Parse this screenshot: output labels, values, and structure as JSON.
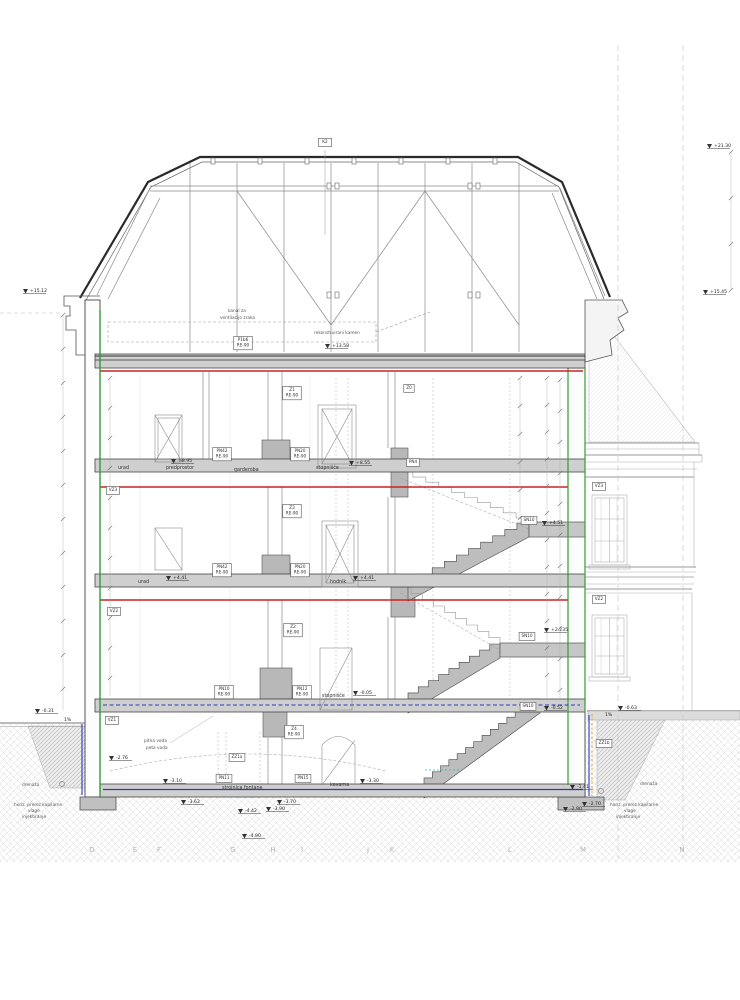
{
  "colors": {
    "slab_red": "#cc2222",
    "wall_green": "#2e9e38",
    "moisture_blue": "#2b3bbb",
    "membrane_orange": "#e0a030",
    "teal_line": "#2ab6c9"
  },
  "tags": [
    {
      "t": "K2",
      "x": 325,
      "y": 143,
      "big": true
    },
    {
      "t": "P1b6|RE-90",
      "x": 243,
      "y": 341
    },
    {
      "t": "Z1|RE-90",
      "x": 292,
      "y": 391
    },
    {
      "t": "Z0",
      "x": 409,
      "y": 389
    },
    {
      "t": "PN42|RE-90",
      "x": 222,
      "y": 452
    },
    {
      "t": "PN20|RE-90",
      "x": 300,
      "y": 452
    },
    {
      "t": "PN4",
      "x": 413,
      "y": 463
    },
    {
      "t": "VZ3",
      "x": 113,
      "y": 491
    },
    {
      "t": "VZ3",
      "x": 599,
      "y": 487
    },
    {
      "t": "Z3|RE-90",
      "x": 292,
      "y": 509
    },
    {
      "t": "SN10",
      "x": 529,
      "y": 521
    },
    {
      "t": "PN42|RE-90",
      "x": 222,
      "y": 568
    },
    {
      "t": "PN20|RE-90",
      "x": 300,
      "y": 568
    },
    {
      "t": "VZ2",
      "x": 114,
      "y": 612
    },
    {
      "t": "VZ2",
      "x": 599,
      "y": 600
    },
    {
      "t": "Z2|RE-90",
      "x": 293,
      "y": 628
    },
    {
      "t": "SN10",
      "x": 527,
      "y": 637
    },
    {
      "t": "PN10|RE-90",
      "x": 224,
      "y": 690
    },
    {
      "t": "PN12|RE-90",
      "x": 302,
      "y": 690
    },
    {
      "t": "SN10",
      "x": 528,
      "y": 707
    },
    {
      "t": "VZ1",
      "x": 112,
      "y": 721
    },
    {
      "t": "Z4|RE-90",
      "x": 294,
      "y": 730
    },
    {
      "t": "ZZ1a",
      "x": 237,
      "y": 758
    },
    {
      "t": "ZZ1b",
      "x": 604,
      "y": 744
    },
    {
      "t": "PN11",
      "x": 224,
      "y": 779
    },
    {
      "t": "PN15",
      "x": 303,
      "y": 779
    }
  ],
  "levels": [
    {
      "t": "+21.30",
      "x": 716,
      "y": 143
    },
    {
      "t": "+15.45",
      "x": 712,
      "y": 289
    },
    {
      "t": "+15.12",
      "x": 32,
      "y": 288
    },
    {
      "t": "+13.58",
      "x": 334,
      "y": 343
    },
    {
      "t": "+8.95",
      "x": 180,
      "y": 458
    },
    {
      "t": "+8.55",
      "x": 358,
      "y": 460
    },
    {
      "t": "+4.51",
      "x": 551,
      "y": 520
    },
    {
      "t": "+4.41",
      "x": 175,
      "y": 575
    },
    {
      "t": "+4.41",
      "x": 362,
      "y": 575
    },
    {
      "t": "+2.235",
      "x": 553,
      "y": 627
    },
    {
      "t": "-0.05",
      "x": 362,
      "y": 690
    },
    {
      "t": "-0.31",
      "x": 44,
      "y": 708
    },
    {
      "t": "1%",
      "x": 66,
      "y": 717,
      "arrow": false
    },
    {
      "t": "1%",
      "x": 607,
      "y": 712,
      "arrow": false
    },
    {
      "t": "-0.63",
      "x": 627,
      "y": 705
    },
    {
      "t": "-0.52",
      "x": 553,
      "y": 705
    },
    {
      "t": "-3.30",
      "x": 369,
      "y": 778
    },
    {
      "t": "-3.10",
      "x": 172,
      "y": 778
    },
    {
      "t": "-2.76",
      "x": 118,
      "y": 755
    },
    {
      "t": "-3.62",
      "x": 190,
      "y": 799
    },
    {
      "t": "-3.70",
      "x": 286,
      "y": 799
    },
    {
      "t": "-3.90",
      "x": 275,
      "y": 806
    },
    {
      "t": "-4.42",
      "x": 247,
      "y": 808
    },
    {
      "t": "-4.90",
      "x": 251,
      "y": 833
    },
    {
      "t": "-2.70",
      "x": 591,
      "y": 801
    },
    {
      "t": "-2.90",
      "x": 572,
      "y": 806
    },
    {
      "t": "-1.41",
      "x": 579,
      "y": 784
    }
  ],
  "rooms": [
    {
      "t": "urad",
      "x": 118,
      "y": 469
    },
    {
      "t": "predprostor",
      "x": 166,
      "y": 469
    },
    {
      "t": "garderoba",
      "x": 234,
      "y": 471
    },
    {
      "t": "stopnišče",
      "x": 316,
      "y": 469
    },
    {
      "t": "urad",
      "x": 138,
      "y": 583
    },
    {
      "t": "hodnik",
      "x": 330,
      "y": 583
    },
    {
      "t": "stopnišče",
      "x": 322,
      "y": 697
    },
    {
      "t": "strojnica fontane",
      "x": 222,
      "y": 789
    },
    {
      "t": "kavarna",
      "x": 330,
      "y": 786
    }
  ],
  "notes": [
    {
      "t": "kanal za",
      "x": 228,
      "y": 312
    },
    {
      "t": "ventilacijo zraka",
      "x": 220,
      "y": 319
    },
    {
      "t": "rekonstruirani kamen",
      "x": 314,
      "y": 334
    },
    {
      "t": "pitna voda",
      "x": 144,
      "y": 742
    },
    {
      "t": "peta voda",
      "x": 146,
      "y": 749
    },
    {
      "t": "drenaža",
      "x": 22,
      "y": 786
    },
    {
      "t": "drenaža",
      "x": 640,
      "y": 785
    },
    {
      "t": "horiz. prerez kapilarne",
      "x": 14,
      "y": 806
    },
    {
      "t": "vlage",
      "x": 28,
      "y": 812
    },
    {
      "t": "injektiranje",
      "x": 22,
      "y": 818
    },
    {
      "t": "horiz. prerez kapilarne",
      "x": 610,
      "y": 806
    },
    {
      "t": "vlage",
      "x": 624,
      "y": 812
    },
    {
      "t": "injektiranje",
      "x": 616,
      "y": 818
    }
  ],
  "grid_letters": [
    {
      "t": "D",
      "x": 92
    },
    {
      "t": "E",
      "x": 135
    },
    {
      "t": "F",
      "x": 159
    },
    {
      "t": "G",
      "x": 233
    },
    {
      "t": "H",
      "x": 273
    },
    {
      "t": "I",
      "x": 302
    },
    {
      "t": "J",
      "x": 368
    },
    {
      "t": "K",
      "x": 392
    },
    {
      "t": "L",
      "x": 510
    },
    {
      "t": "M",
      "x": 583
    },
    {
      "t": "N",
      "x": 682
    }
  ],
  "figure": {
    "grid_y": 852,
    "flights": [
      {
        "x0": 408,
        "y0": 587,
        "x1": 529,
        "y1": 523,
        "n": 10,
        "type": "solid"
      },
      {
        "x0": 400,
        "y0": 472,
        "x1": 529,
        "y1": 523,
        "n": 10,
        "type": "light"
      },
      {
        "x0": 408,
        "y0": 699,
        "x1": 500,
        "y1": 644,
        "n": 9,
        "type": "solid"
      },
      {
        "x0": 400,
        "y0": 587,
        "x1": 500,
        "y1": 644,
        "n": 9,
        "type": "light"
      },
      {
        "x0": 424,
        "y0": 784,
        "x1": 540,
        "y1": 699,
        "n": 14,
        "type": "solid"
      }
    ],
    "landings": [
      {
        "x": 529,
        "y": 522,
        "w": 56,
        "h": 15
      },
      {
        "x": 500,
        "y": 643,
        "w": 85,
        "h": 14
      }
    ],
    "dim_chains": [
      {
        "x": 63,
        "y0": 315,
        "y1": 710,
        "step": 34
      },
      {
        "x": 110,
        "y0": 378,
        "y1": 696,
        "step": 30
      },
      {
        "x": 520,
        "y0": 378,
        "y1": 518,
        "step": 28
      },
      {
        "x": 547,
        "y0": 378,
        "y1": 698,
        "step": 27
      },
      {
        "x": 560,
        "y0": 380,
        "y1": 698,
        "step": 31
      },
      {
        "x": 731,
        "y0": 152,
        "y1": 290,
        "step": 46
      }
    ]
  }
}
